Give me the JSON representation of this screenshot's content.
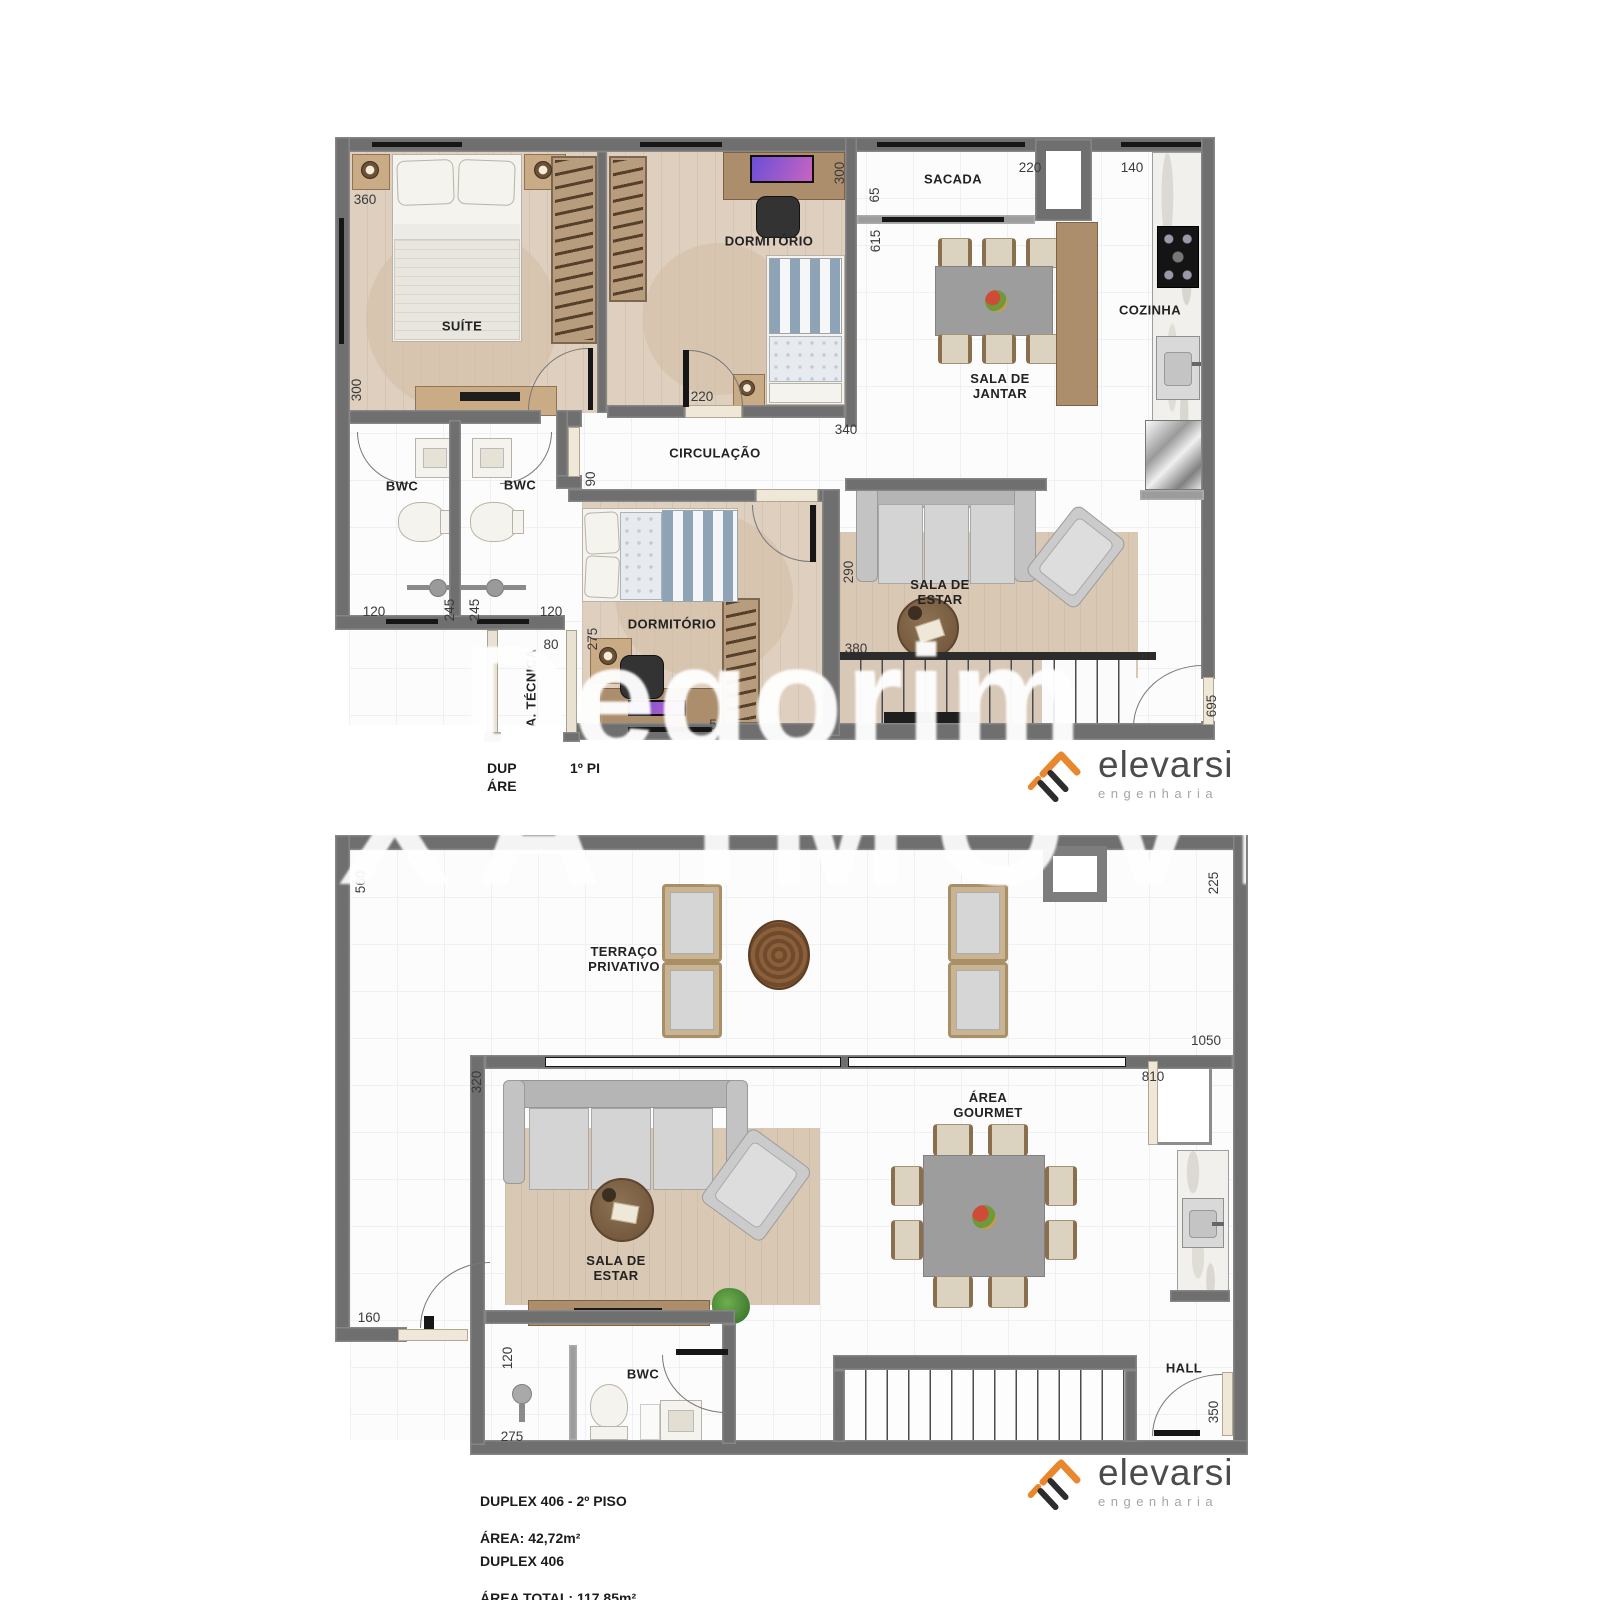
{
  "sheet": {
    "background": "#ffffff"
  },
  "branding": {
    "logo_name": "elevarsi",
    "logo_subtitle": "engenharia",
    "logo_accent": "#e8872e",
    "logo_dark": "#2d2d2d",
    "watermark_large": "Degorim",
    "watermark_partial": "XA IMÓVEIS"
  },
  "plan1": {
    "caption": {
      "left_fragment": "DUP\nÁRE",
      "right_fragment": "1º PI"
    },
    "labels": [
      {
        "n": "room-label-suite",
        "t": "SUÍTE",
        "x": 462,
        "y": 327,
        "b": true
      },
      {
        "n": "room-label-dormitorio-1",
        "t": "DORMITÓRIO",
        "x": 769,
        "y": 242,
        "b": true
      },
      {
        "n": "room-label-sacada",
        "t": "SACADA",
        "x": 953,
        "y": 180,
        "b": true
      },
      {
        "n": "room-label-cozinha",
        "t": "COZINHA",
        "x": 1150,
        "y": 311,
        "b": true
      },
      {
        "n": "room-label-sala-jantar",
        "t": "SALA DE\nJANTAR",
        "x": 1000,
        "y": 387,
        "b": true
      },
      {
        "n": "room-label-circulacao",
        "t": "CIRCULAÇÃO",
        "x": 715,
        "y": 454,
        "b": true
      },
      {
        "n": "room-label-bwc-1",
        "t": "BWC",
        "x": 402,
        "y": 487,
        "b": true
      },
      {
        "n": "room-label-bwc-2",
        "t": "BWC",
        "x": 520,
        "y": 486,
        "b": true
      },
      {
        "n": "room-label-dormitorio-2",
        "t": "DORMITÓRIO",
        "x": 672,
        "y": 625,
        "b": true
      },
      {
        "n": "room-label-sala-estar",
        "t": "SALA DE\nESTAR",
        "x": 940,
        "y": 593,
        "b": true
      },
      {
        "n": "room-label-area-tecnica",
        "t": "A. TÉCNICA",
        "x": 532,
        "y": 688,
        "b": true,
        "rot": true
      },
      {
        "n": "dim-label",
        "t": "360",
        "x": 365,
        "y": 200
      },
      {
        "n": "dim-label",
        "t": "300",
        "x": 357,
        "y": 390,
        "rot": true
      },
      {
        "n": "dim-label",
        "t": "300",
        "x": 840,
        "y": 173,
        "rot": true
      },
      {
        "n": "dim-label",
        "t": "65",
        "x": 875,
        "y": 195,
        "rot": true
      },
      {
        "n": "dim-label",
        "t": "615",
        "x": 876,
        "y": 241,
        "rot": true
      },
      {
        "n": "dim-label",
        "t": "220",
        "x": 1030,
        "y": 168
      },
      {
        "n": "dim-label",
        "t": "140",
        "x": 1132,
        "y": 168
      },
      {
        "n": "dim-label",
        "t": "220",
        "x": 702,
        "y": 397
      },
      {
        "n": "dim-label",
        "t": "340",
        "x": 846,
        "y": 430
      },
      {
        "n": "dim-label",
        "t": "90",
        "x": 591,
        "y": 479,
        "rot": true
      },
      {
        "n": "dim-label",
        "t": "120",
        "x": 374,
        "y": 612
      },
      {
        "n": "dim-label",
        "t": "245",
        "x": 450,
        "y": 610,
        "rot": true
      },
      {
        "n": "dim-label",
        "t": "245",
        "x": 475,
        "y": 610,
        "rot": true
      },
      {
        "n": "dim-label",
        "t": "120",
        "x": 551,
        "y": 612
      },
      {
        "n": "dim-label",
        "t": "80",
        "x": 551,
        "y": 645
      },
      {
        "n": "dim-label",
        "t": "275",
        "x": 593,
        "y": 639,
        "rot": true
      },
      {
        "n": "dim-label",
        "t": "290",
        "x": 849,
        "y": 572,
        "rot": true
      },
      {
        "n": "dim-label",
        "t": "380",
        "x": 856,
        "y": 649
      },
      {
        "n": "dim-label",
        "t": "695",
        "x": 1212,
        "y": 706,
        "rot": true
      },
      {
        "n": "dim-label",
        "t": "5",
        "x": 713,
        "y": 725
      }
    ]
  },
  "plan2": {
    "caption": {
      "title": "DUPLEX 406 - 2º PISO",
      "area": "ÁREA: 42,72m²"
    },
    "caption_total": {
      "title": "DUPLEX 406",
      "area": "ÁREA TOTAL: 117,85m²"
    },
    "labels": [
      {
        "n": "room-label-terraco",
        "t": "TERRAÇO\nPRIVATIVO",
        "x": 624,
        "y": 960,
        "b": true
      },
      {
        "n": "room-label-area-gourmet",
        "t": "ÁREA\nGOURMET",
        "x": 988,
        "y": 1106,
        "b": true
      },
      {
        "n": "room-label-sala-estar-2",
        "t": "SALA DE\nESTAR",
        "x": 616,
        "y": 1269,
        "b": true
      },
      {
        "n": "room-label-bwc-3",
        "t": "BWC",
        "x": 643,
        "y": 1375,
        "b": true
      },
      {
        "n": "room-label-hall",
        "t": "HALL",
        "x": 1184,
        "y": 1369,
        "b": true
      },
      {
        "n": "dim-label",
        "t": "560",
        "x": 361,
        "y": 882,
        "rot": true
      },
      {
        "n": "dim-label",
        "t": "225",
        "x": 1214,
        "y": 883,
        "rot": true
      },
      {
        "n": "dim-label",
        "t": "1050",
        "x": 1206,
        "y": 1041
      },
      {
        "n": "dim-label",
        "t": "810",
        "x": 1153,
        "y": 1077
      },
      {
        "n": "dim-label",
        "t": "320",
        "x": 477,
        "y": 1082,
        "rot": true
      },
      {
        "n": "dim-label",
        "t": "160",
        "x": 369,
        "y": 1318
      },
      {
        "n": "dim-label",
        "t": "120",
        "x": 508,
        "y": 1358,
        "rot": true
      },
      {
        "n": "dim-label",
        "t": "275",
        "x": 512,
        "y": 1437
      },
      {
        "n": "dim-label",
        "t": "350",
        "x": 1214,
        "y": 1412,
        "rot": true
      }
    ]
  }
}
